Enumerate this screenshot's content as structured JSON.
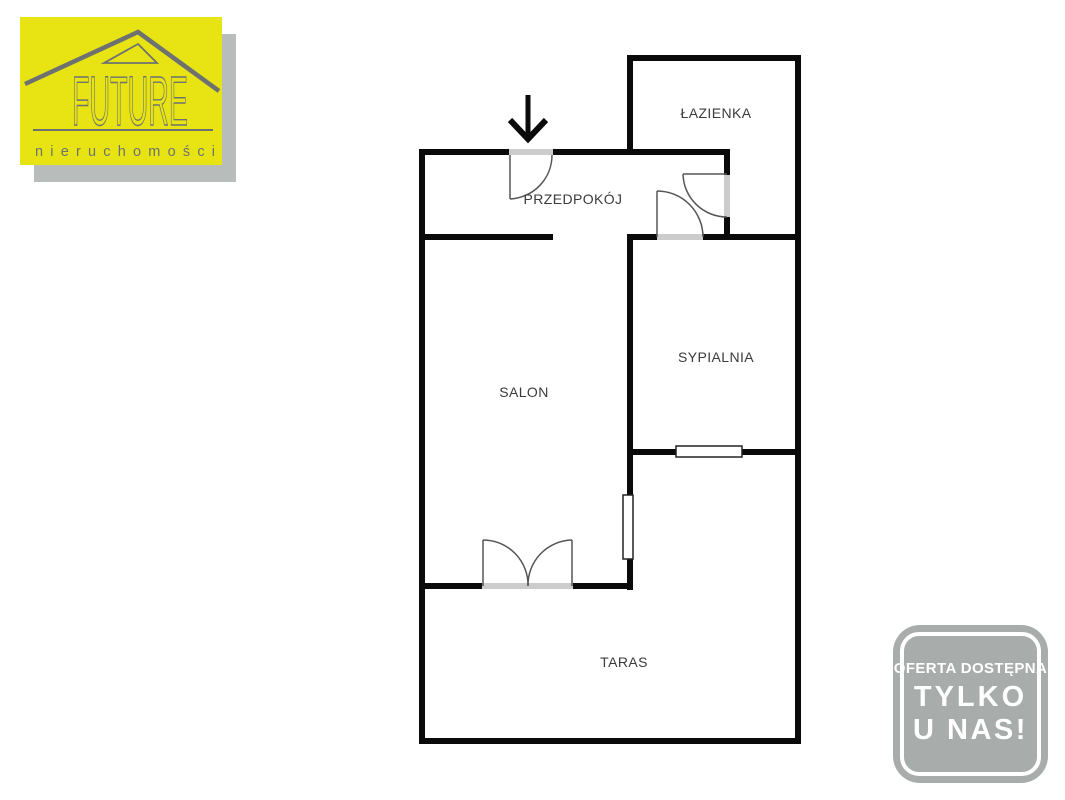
{
  "logo": {
    "brand": "FUTURE",
    "subtitle": "nieruchomości",
    "colors": {
      "bg": "#e8e313",
      "fg": "#6d7271",
      "shadow": "#b8bcbb"
    }
  },
  "badge": {
    "line1": "OFERTA DOSTĘPNA",
    "line2": "TYLKO",
    "line3": "U NAS!",
    "colors": {
      "bg": "#a8acab",
      "fg": "#ffffff"
    }
  },
  "plan": {
    "colors": {
      "wall": "#0a0a0a",
      "opening": "#cccccc",
      "thin": "#555555",
      "window_border": "#222222",
      "label": "#3b3b3b"
    },
    "walls": [
      [
        419,
        149,
        6,
        595
      ],
      [
        419,
        738,
        382,
        6
      ],
      [
        795,
        55,
        6,
        689
      ],
      [
        627,
        55,
        174,
        6
      ],
      [
        627,
        55,
        6,
        100
      ],
      [
        419,
        149,
        311,
        6
      ],
      [
        724,
        149,
        6,
        91
      ],
      [
        419,
        234,
        134,
        6
      ],
      [
        627,
        234,
        174,
        6
      ],
      [
        627,
        234,
        6,
        356
      ],
      [
        627,
        449,
        174,
        6
      ],
      [
        419,
        583,
        214,
        6
      ]
    ],
    "openings": [
      [
        509,
        149,
        44,
        6
      ],
      [
        724,
        175,
        6,
        42
      ],
      [
        657,
        234,
        46,
        6
      ],
      [
        482,
        583,
        91,
        6
      ]
    ],
    "windows": [
      [
        676,
        446,
        66,
        11
      ],
      [
        623,
        495,
        10,
        64
      ]
    ],
    "door_leaves": [
      [
        510,
        155,
        510,
        199
      ],
      [
        727,
        174,
        683,
        174
      ],
      [
        657,
        237,
        657,
        191
      ],
      [
        483,
        586,
        483,
        540
      ],
      [
        572,
        586,
        572,
        540
      ]
    ],
    "door_arcs": [
      "M 510 199 A 44 44 0 0 0 552 155",
      "M 683 174 A 44 44 0 0 0 727 217",
      "M 657 191 A 46 46 0 0 1 703 237",
      "M 483 540 A 45 45 0 0 1 528 586",
      "M 572 540 A 45 45 0 0 0 528 586"
    ],
    "arrow": {
      "shaft": [
        528,
        95,
        528,
        136
      ],
      "head": "510,120 528,139 546,120"
    },
    "rooms": [
      {
        "name": "ŁAZIENKA",
        "x": 716,
        "y": 118
      },
      {
        "name": "PRZEDPOKÓJ",
        "x": 573,
        "y": 204
      },
      {
        "name": "SYPIALNIA",
        "x": 716,
        "y": 362
      },
      {
        "name": "SALON",
        "x": 524,
        "y": 397
      },
      {
        "name": "TARAS",
        "x": 624,
        "y": 667
      }
    ]
  }
}
